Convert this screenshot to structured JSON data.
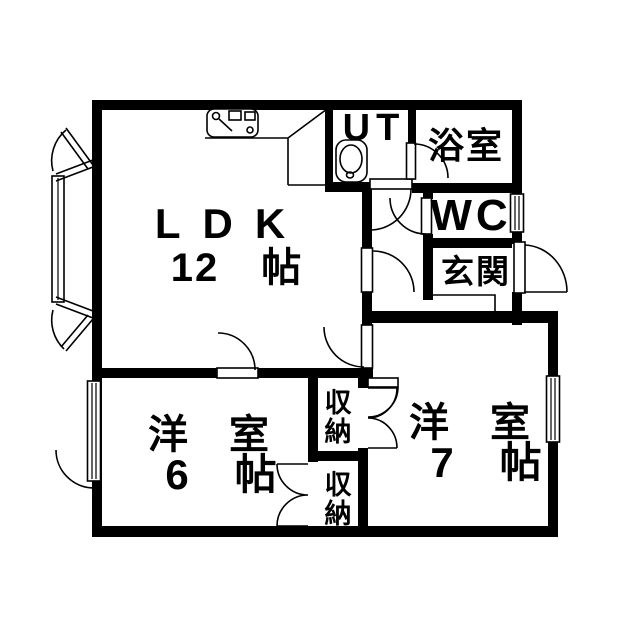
{
  "canvas": {
    "background": "#ffffff",
    "line_color": "#000000"
  },
  "rooms": {
    "ldk": {
      "label": "LDK",
      "size": "12　帖"
    },
    "ut": {
      "label": "UT"
    },
    "bath": {
      "label": "浴室"
    },
    "wc": {
      "label": "WC"
    },
    "entrance": {
      "label": "玄関"
    },
    "western6": {
      "label": "洋 室",
      "size": "6　帖"
    },
    "western7": {
      "label": "洋 室",
      "size": "7　帖"
    },
    "storage_upper": {
      "char1": "収",
      "char2": "納"
    },
    "storage_lower": {
      "char1": "収",
      "char2": "納"
    }
  }
}
